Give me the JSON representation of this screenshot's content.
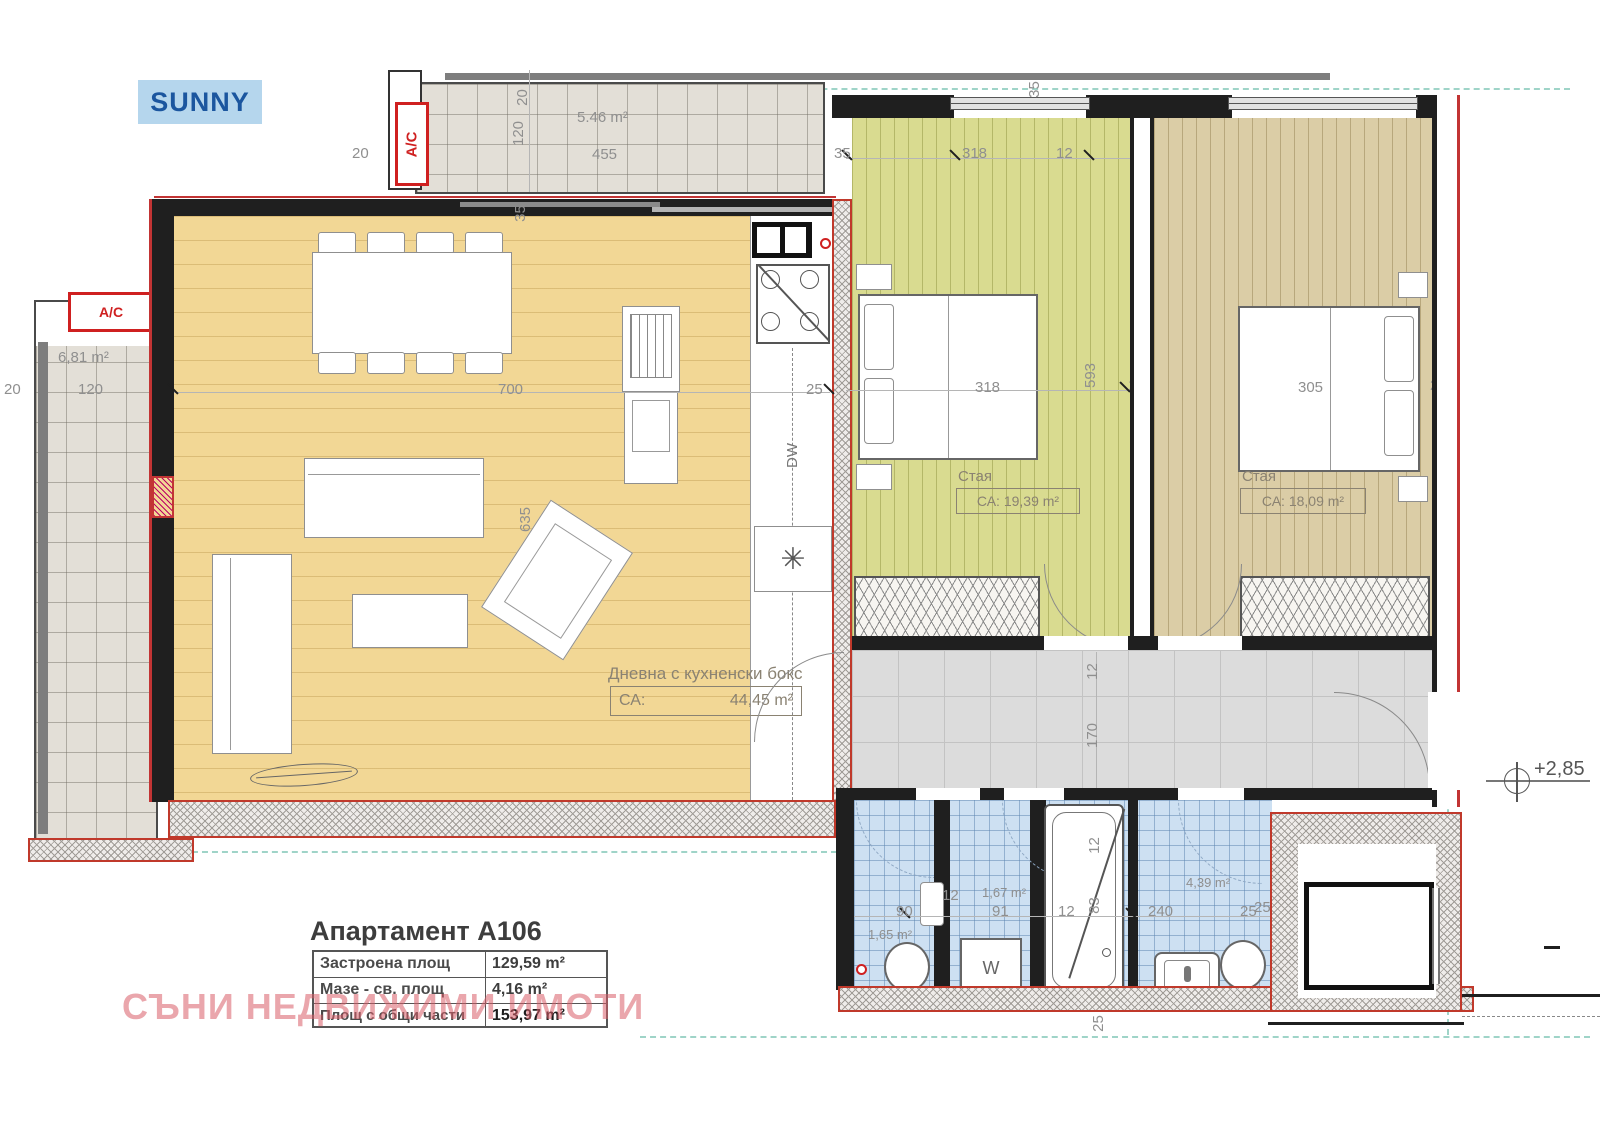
{
  "logo": {
    "text": "SUNNY"
  },
  "ac": {
    "label": "A/C"
  },
  "watermark": {
    "text": "СЪНИ НЕДВИЖИМИ ИМОТИ"
  },
  "level_mark": {
    "text": "+2,85"
  },
  "info_table": {
    "title": "Апартамент А106",
    "rows": [
      {
        "label": "Застроена площ",
        "value": "129,59 m²"
      },
      {
        "label": "Мазе - св. площ",
        "value": "4,16 m²"
      },
      {
        "label": "Площ с общи части",
        "value": "153,97 m²"
      }
    ]
  },
  "rooms": {
    "living": {
      "name": "Дневна с кухненски бокс",
      "area_prefix": "СА:",
      "area": "44,45 m²"
    },
    "bedroom1": {
      "name": "Стая",
      "area": "СА: 19,39 m²"
    },
    "bedroom2": {
      "name": "Стая",
      "area": "СА: 18,09 m²"
    },
    "balcony_top": {
      "area": "5.46 m²"
    },
    "balcony_left": {
      "area": "6,81 m²"
    },
    "bath1": {
      "area": "1,65 m²"
    },
    "bath2": {
      "area": "1,67 m²"
    },
    "bath3": {
      "area": "4,39 m²"
    }
  },
  "appliances": {
    "washer": "W",
    "dishwasher": "DW",
    "fridge_symbol": "✳"
  },
  "dims": {
    "top_left_offset": "20",
    "balcony_top_gap": "20",
    "balcony_top_depth": "120",
    "balcony_top_width": "455",
    "living_top_wall": "35",
    "bed1_top_left": "35",
    "bed1_top_width": "318",
    "bed1_top_wall": "12",
    "bed1_top_vert": "35",
    "left_offset": "20",
    "balcony_left_width": "120",
    "balcony_left_wall": "35",
    "living_width": "700",
    "living_height": "635",
    "kitchen_wall": "25",
    "bed1_width": "318",
    "bed1_height": "593",
    "bed1_wall": "12",
    "bed2_width": "305",
    "bed2_wall": "25",
    "corr_wall": "12",
    "corr_width": "170",
    "bath1_width": "90",
    "bath1_wall": "12",
    "bath2_width": "91",
    "bath2_wall": "12",
    "tub_width": "83",
    "tub_top": "12",
    "bath3_width": "240",
    "bath3_wall": "25",
    "bottom_wall": "25",
    "storage_wall": "25"
  }
}
